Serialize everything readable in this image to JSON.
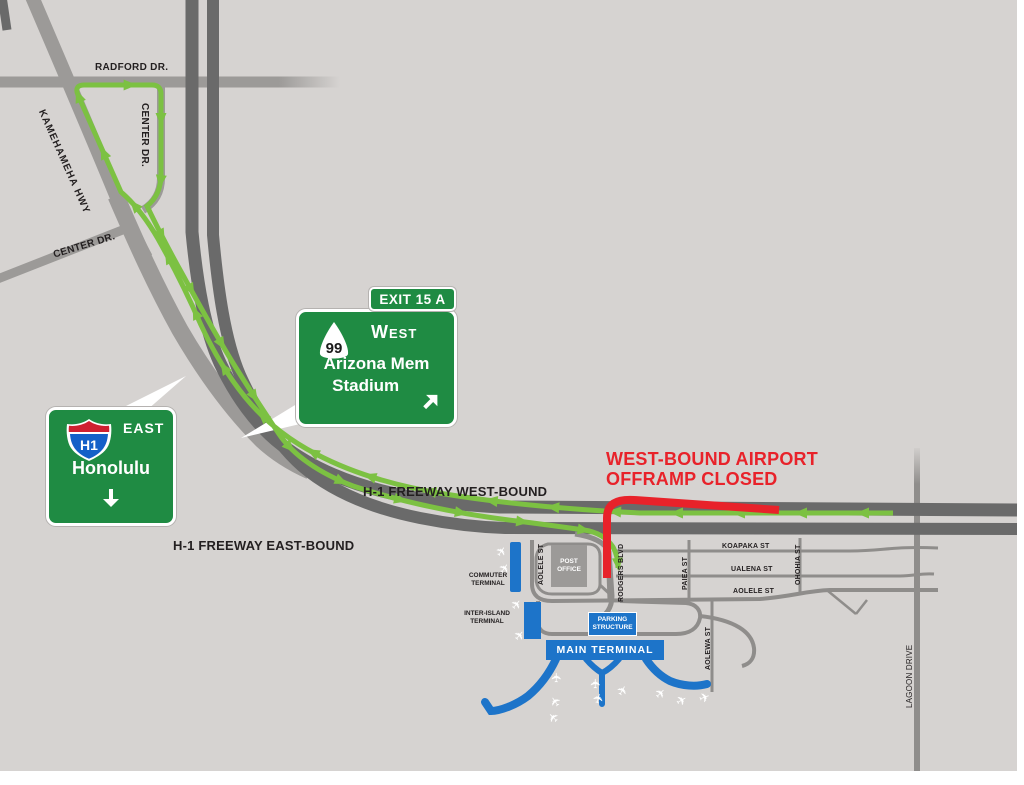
{
  "title": "West-bound airport offramp closure detour map",
  "colors": {
    "background": "#d6d3d1",
    "road_dark": "#6a6a6a",
    "road_medium": "#9c9a98",
    "road_thin": "#8f8d8b",
    "route_green": "#7cc142",
    "sign_green": "#1f8b43",
    "closure_red": "#e8222a",
    "airport_blue": "#1d74c9",
    "text_black": "#231f20"
  },
  "closure_notice": {
    "line1": "WEST-BOUND AIRPORT",
    "line2": "OFFRAMP CLOSED"
  },
  "freeway": {
    "westbound_label": "H-1 FREEWAY WEST-BOUND",
    "eastbound_label": "H-1 FREEWAY EAST-BOUND"
  },
  "signs": {
    "exit_tab": "EXIT 15 A",
    "west_sign": {
      "route": "99",
      "direction": "West",
      "dest_line1": "Arizona Mem",
      "dest_line2": "Stadium"
    },
    "east_sign": {
      "route": "H1",
      "direction": "EAST",
      "destination": "Honolulu"
    }
  },
  "streets": {
    "radford": "RADFORD DR.",
    "center_upper": "CENTER DR.",
    "kamehameha": "KAMEHAMEHA HWY",
    "center_lower": "CENTER DR.",
    "koapaka": "KOAPAKA ST",
    "ualena": "UALENA ST",
    "aolele_east": "AOLELE ST",
    "aolele_west": "AOLELE ST",
    "rodgers": "RODGERS BLVD",
    "paiea": "PAIEA ST",
    "ohohia": "OHOHIA ST",
    "aolewa": "AOLEWA ST",
    "lagoon": "LAGOON DRIVE"
  },
  "airport": {
    "commuter": {
      "line1": "COMMUTER",
      "line2": "TERMINAL"
    },
    "inter_island": {
      "line1": "INTER-ISLAND",
      "line2": "TERMINAL"
    },
    "post_office": {
      "line1": "POST",
      "line2": "OFFICE"
    },
    "parking": {
      "line1": "PARKING",
      "line2": "STRUCTURE"
    },
    "main_terminal": "MAIN TERMINAL"
  },
  "icons": {
    "airplane": "✈"
  }
}
